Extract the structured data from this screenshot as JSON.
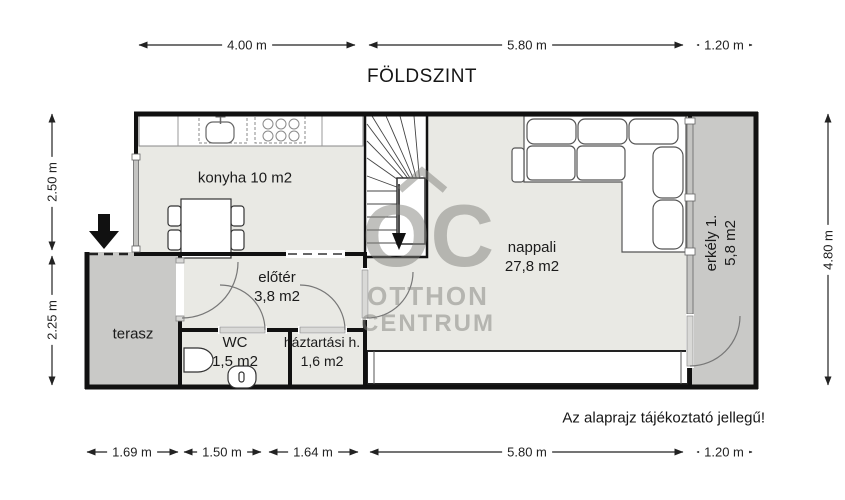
{
  "title": "FÖLDSZINT",
  "note": "Az alaprajz tájékoztató jellegű!",
  "watermark": {
    "initials": "OC",
    "name_line1": "OTTHON",
    "name_line2": "CENTRUM"
  },
  "rooms": {
    "konyha": {
      "label": "konyha 10 m2"
    },
    "nappali": {
      "name": "nappali",
      "area": "27,8 m2"
    },
    "erkely": {
      "name": "erkély 1.",
      "area": "5,8 m2"
    },
    "eloter": {
      "name": "előtér",
      "area": "3,8 m2"
    },
    "terasz": {
      "name": "terasz"
    },
    "wc": {
      "name": "WC",
      "area": "1,5 m2"
    },
    "haztartasi": {
      "name": "háztartási h.",
      "area": "1,6 m2"
    }
  },
  "dimensions": {
    "top": [
      "4.00 m",
      "5.80 m",
      "1.20 m"
    ],
    "bottom": [
      "1.69 m",
      "1.50 m",
      "1.64 m",
      "5.80 m",
      "1.20 m"
    ],
    "left": [
      "2.50 m",
      "2.25 m"
    ],
    "right": [
      "4.80 m"
    ]
  },
  "colors": {
    "wall": "#111111",
    "room_fill": "#e9e9e4",
    "outdoor_fill": "#c9c9c7",
    "watermark_gray": "#b5b5b1"
  }
}
